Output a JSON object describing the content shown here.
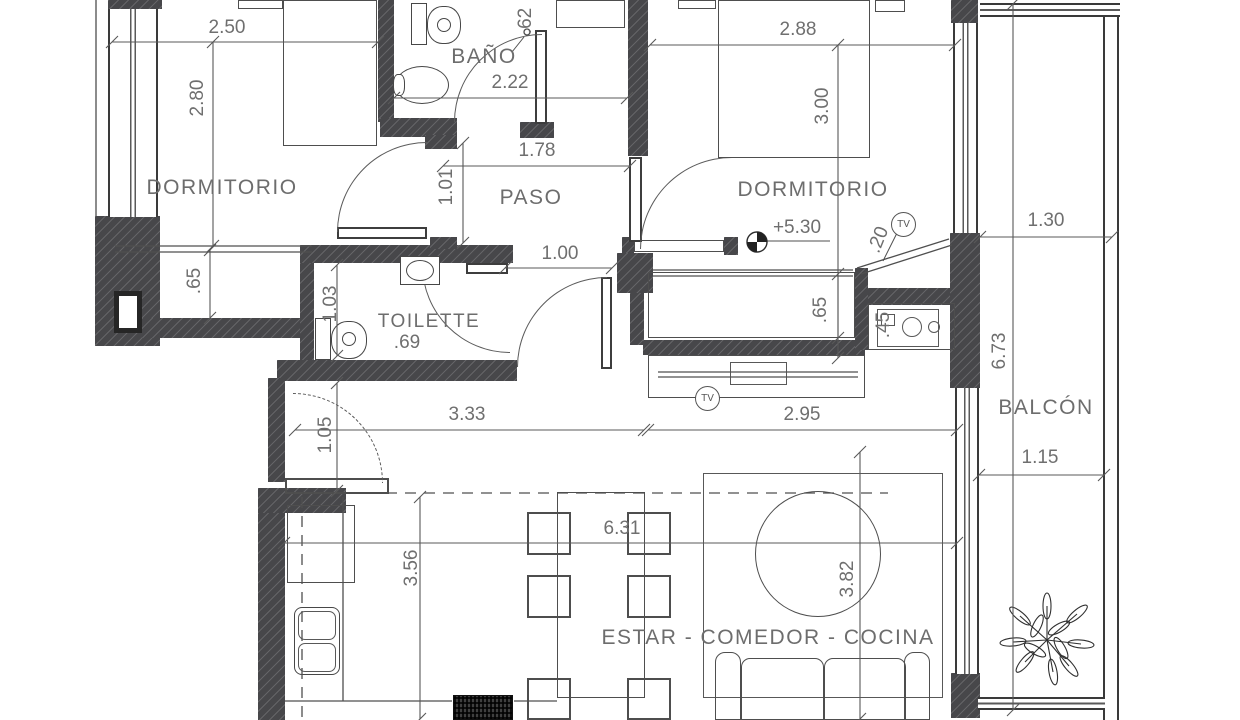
{
  "title": "Apartment floor plan",
  "plan": {
    "tv_label": "TV",
    "rooms": [
      {
        "t": "DORMITORIO",
        "x": 222,
        "y": 188
      },
      {
        "t": "BAÑO",
        "x": 484,
        "y": 57
      },
      {
        "t": "PASO",
        "x": 531,
        "y": 198
      },
      {
        "t": "DORMITORIO",
        "x": 813,
        "y": 190
      },
      {
        "t": "TOILETTE",
        "x": 429,
        "y": 322,
        "size": 19
      },
      {
        "t": "BALCÓN",
        "x": 1046,
        "y": 408
      },
      {
        "t": "ESTAR - COMEDOR - COCINA",
        "x": 768,
        "y": 638
      }
    ],
    "dims": [
      {
        "t": "2.50",
        "line": [
          112,
          42,
          378,
          42
        ],
        "tx": 227,
        "ty": 28,
        "rot": 0
      },
      {
        "t": "2.80",
        "line": [
          213,
          42,
          213,
          246
        ],
        "tx": 198,
        "ty": 98,
        "rot": -90
      },
      {
        "t": "2.22",
        "line": [
          394,
          98,
          627,
          98
        ],
        "tx": 510,
        "ty": 83,
        "rot": 0
      },
      {
        "t": "1.78",
        "line": [
          443,
          166,
          630,
          166
        ],
        "tx": 537,
        "ty": 151,
        "rot": 0
      },
      {
        "t": "1.01",
        "line": [
          463,
          143,
          463,
          243
        ],
        "tx": 447,
        "ty": 187,
        "rot": -90
      },
      {
        "t": "1.00",
        "line": [
          505,
          268,
          612,
          268
        ],
        "tx": 560,
        "ty": 254,
        "rot": 0
      },
      {
        "t": "2.88",
        "line": [
          650,
          45,
          955,
          45
        ],
        "tx": 798,
        "ty": 30,
        "rot": 0
      },
      {
        "t": "3.00",
        "line": [
          838,
          45,
          838,
          358
        ],
        "tx": 823,
        "ty": 106,
        "rot": -90
      },
      {
        "t": ".65",
        "line": [
          210,
          250,
          210,
          318
        ],
        "tx": 195,
        "ty": 281,
        "rot": -90
      },
      {
        "t": "1.03",
        "line": [
          337,
          265,
          337,
          356
        ],
        "tx": 331,
        "ty": 304,
        "rot": -90
      },
      {
        "t": ".69",
        "tx": 407,
        "ty": 343,
        "rot": 0
      },
      {
        "t": ".65",
        "line": [
          838,
          274,
          838,
          338
        ],
        "tx": 821,
        "ty": 310,
        "rot": -90
      },
      {
        "t": ".45",
        "tx": 884,
        "ty": 325,
        "rot": -90
      },
      {
        "t": ".20",
        "tx": 879,
        "ty": 240,
        "rot": -68
      },
      {
        "t": ".62",
        "tx": 526,
        "ty": 21,
        "rot": -90
      },
      {
        "t": "3.33",
        "line": [
          295,
          430,
          644,
          430
        ],
        "tx": 467,
        "ty": 415,
        "rot": 0
      },
      {
        "t": "2.95",
        "line": [
          648,
          430,
          957,
          430
        ],
        "tx": 802,
        "ty": 415,
        "rot": 0
      },
      {
        "t": "1.05",
        "line": [
          337,
          383,
          337,
          491
        ],
        "tx": 326,
        "ty": 435,
        "rot": -90
      },
      {
        "t": "3.56",
        "line": [
          420,
          497,
          420,
          719
        ],
        "tx": 412,
        "ty": 568,
        "rot": -90
      },
      {
        "t": "6.31",
        "line": [
          284,
          543,
          957,
          543
        ],
        "tx": 622,
        "ty": 529,
        "rot": 0
      },
      {
        "t": "3.82",
        "line": [
          860,
          452,
          860,
          719
        ],
        "tx": 848,
        "ty": 579,
        "rot": -90
      },
      {
        "t": "1.30",
        "line": [
          980,
          237,
          1112,
          237
        ],
        "tx": 1046,
        "ty": 221,
        "rot": 0
      },
      {
        "t": "6.73",
        "line": [
          1013,
          4,
          1013,
          710
        ],
        "tx": 1000,
        "ty": 351,
        "rot": -90
      },
      {
        "t": "1.15",
        "line": [
          979,
          475,
          1104,
          475
        ],
        "tx": 1040,
        "ty": 458,
        "rot": 0
      },
      {
        "t": "+5.30",
        "tx": 797,
        "ty": 228,
        "rot": 0
      }
    ]
  }
}
